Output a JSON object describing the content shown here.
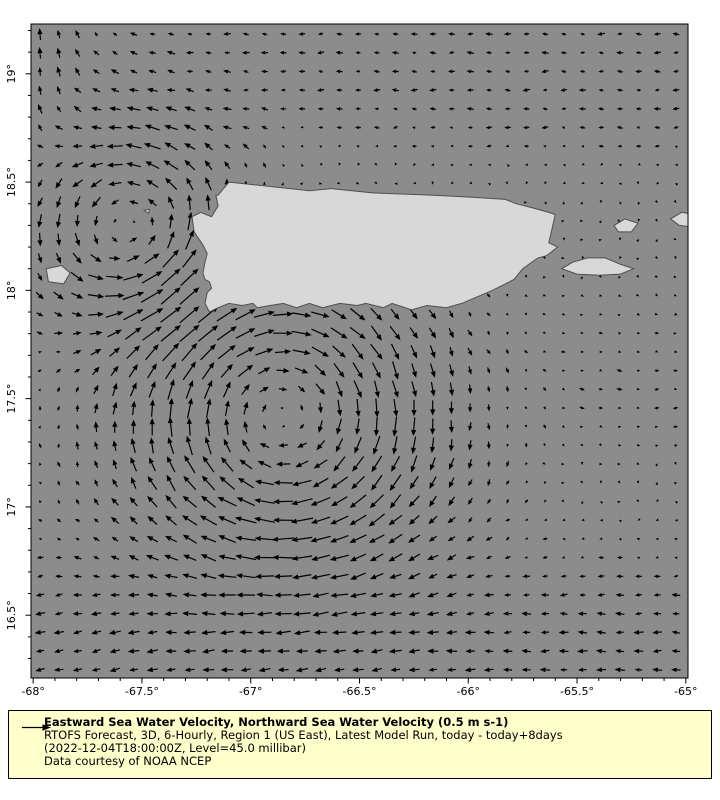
{
  "map": {
    "extent": {
      "lon_min": -68.01,
      "lon_max": -64.99,
      "lat_min": 16.21,
      "lat_max": 19.23
    },
    "colors": {
      "sea": "#8c8c8c",
      "land": "#d8d8d8",
      "land_edge": "#4f4f4f",
      "frame": "#000000",
      "arrow": "#000000"
    },
    "axes": {
      "lon_ticks": [
        {
          "value": -68,
          "label": "-68°"
        },
        {
          "value": -67.5,
          "label": "-67.5°"
        },
        {
          "value": -67,
          "label": "-67°"
        },
        {
          "value": -66.5,
          "label": "-66.5°"
        },
        {
          "value": -66,
          "label": "-66°"
        },
        {
          "value": -65.5,
          "label": "-65.5°"
        },
        {
          "value": -65,
          "label": "-65°"
        }
      ],
      "lat_ticks": [
        {
          "value": 19,
          "label": "19°"
        },
        {
          "value": 18.5,
          "label": "18.5°"
        },
        {
          "value": 18,
          "label": "18°"
        },
        {
          "value": 17.5,
          "label": "17.5°"
        },
        {
          "value": 17,
          "label": "17°"
        },
        {
          "value": 16.5,
          "label": "16.5°"
        }
      ],
      "minor_step": 0.1
    },
    "islands": {
      "puerto_rico": [
        [
          -67.15,
          18.44
        ],
        [
          -67.1,
          18.5
        ],
        [
          -66.73,
          18.46
        ],
        [
          -66.63,
          18.47
        ],
        [
          -66.44,
          18.45
        ],
        [
          -66.17,
          18.44
        ],
        [
          -65.98,
          18.43
        ],
        [
          -65.83,
          18.42
        ],
        [
          -65.78,
          18.4
        ],
        [
          -65.7,
          18.38
        ],
        [
          -65.63,
          18.36
        ],
        [
          -65.6,
          18.35
        ],
        [
          -65.63,
          18.22
        ],
        [
          -65.59,
          18.2
        ],
        [
          -65.64,
          18.16
        ],
        [
          -65.68,
          18.15
        ],
        [
          -65.75,
          18.1
        ],
        [
          -65.79,
          18.05
        ],
        [
          -65.83,
          18.03
        ],
        [
          -65.89,
          18.0
        ],
        [
          -65.96,
          17.97
        ],
        [
          -66.03,
          17.94
        ],
        [
          -66.1,
          17.92
        ],
        [
          -66.19,
          17.93
        ],
        [
          -66.26,
          17.91
        ],
        [
          -66.35,
          17.94
        ],
        [
          -66.39,
          17.92
        ],
        [
          -66.47,
          17.94
        ],
        [
          -66.51,
          17.93
        ],
        [
          -66.59,
          17.94
        ],
        [
          -66.67,
          17.92
        ],
        [
          -66.73,
          17.94
        ],
        [
          -66.79,
          17.92
        ],
        [
          -66.85,
          17.94
        ],
        [
          -66.91,
          17.93
        ],
        [
          -66.97,
          17.92
        ],
        [
          -66.99,
          17.94
        ],
        [
          -67.04,
          17.93
        ],
        [
          -67.1,
          17.94
        ],
        [
          -67.15,
          17.92
        ],
        [
          -67.19,
          17.9
        ],
        [
          -67.21,
          17.94
        ],
        [
          -67.2,
          17.99
        ],
        [
          -67.18,
          18.01
        ],
        [
          -67.19,
          18.04
        ],
        [
          -67.21,
          18.05
        ],
        [
          -67.22,
          18.08
        ],
        [
          -67.21,
          18.13
        ],
        [
          -67.2,
          18.17
        ],
        [
          -67.22,
          18.21
        ],
        [
          -67.26,
          18.27
        ],
        [
          -67.27,
          18.34
        ],
        [
          -67.23,
          18.36
        ],
        [
          -67.18,
          18.34
        ],
        [
          -67.15,
          18.39
        ],
        [
          -67.16,
          18.44
        ]
      ],
      "mona": [
        [
          -67.94,
          18.1
        ],
        [
          -67.87,
          18.115
        ],
        [
          -67.83,
          18.08
        ],
        [
          -67.86,
          18.03
        ],
        [
          -67.93,
          18.04
        ]
      ],
      "desecheo": [
        [
          -67.49,
          18.37
        ],
        [
          -67.465,
          18.375
        ],
        [
          -67.47,
          18.355
        ]
      ],
      "vieques": [
        [
          -65.57,
          18.1
        ],
        [
          -65.52,
          18.13
        ],
        [
          -65.45,
          18.15
        ],
        [
          -65.37,
          18.15
        ],
        [
          -65.3,
          18.12
        ],
        [
          -65.24,
          18.1
        ],
        [
          -65.3,
          18.075
        ],
        [
          -65.4,
          18.07
        ],
        [
          -65.5,
          18.075
        ]
      ],
      "culebra": [
        [
          -65.33,
          18.3
        ],
        [
          -65.28,
          18.33
        ],
        [
          -65.22,
          18.31
        ],
        [
          -65.25,
          18.27
        ],
        [
          -65.31,
          18.27
        ]
      ],
      "st_thomas": [
        [
          -65.07,
          18.33
        ],
        [
          -65.02,
          18.36
        ],
        [
          -64.95,
          18.35
        ],
        [
          -64.95,
          18.29
        ],
        [
          -65.03,
          18.3
        ]
      ]
    },
    "quiver": {
      "grid": {
        "cols": 35,
        "rows": 35,
        "x0": 40,
        "y0": 34,
        "step": 18.7
      },
      "scale_px_per_ms": 46,
      "reference_speed_ms": 0.5,
      "field": {
        "vortices": [
          {
            "lon": -67.55,
            "lat": 18.27,
            "r": 0.3,
            "s": 0.32
          },
          {
            "lon": -66.85,
            "lat": 17.42,
            "r": 0.45,
            "s": -0.42
          }
        ],
        "north": {
          "lat0": 18.4,
          "ramp": 0.4,
          "u": -0.13,
          "u2_amp": 0.12,
          "u2_lon": -68.05,
          "u2_sigma": 0.4,
          "v_amp": 0.26,
          "v_lon": -68.1,
          "v_sigma": 0.45
        },
        "south": {
          "amp": -0.2,
          "lat0": 16.35,
          "sigma": 0.5,
          "v_amp": -0.06,
          "v_lon": -67.6,
          "v_sigma": 0.9
        },
        "east": {
          "amp": 0.1,
          "lon0": -65.25,
          "lat0": 17.55,
          "sigma": 0.5
        },
        "jitter": 0.035
      }
    }
  },
  "legend": {
    "bg_color": "#ffffcc",
    "title": "Eastward Sea Water Velocity, Northward Sea Water Velocity (0.5 m s-1)",
    "line2": "RTOFS Forecast, 3D, 6-Hourly, Region 1 (US East), Latest Model Run, today - today+8days",
    "line3": "(2022-12-04T18:00:00Z, Level=45.0 millibar)",
    "line4": "Data courtesy of NOAA NCEP"
  }
}
